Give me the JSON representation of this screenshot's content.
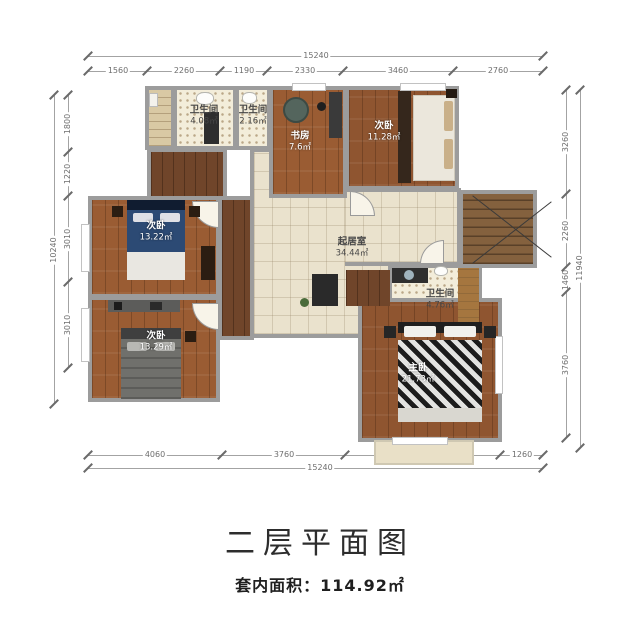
{
  "title": "二层平面图",
  "subtitle": "套内面积：114.92㎡",
  "rooms": {
    "bath_top_left": {
      "name": "卫生间",
      "area": "4.08㎡"
    },
    "bath_top_mid": {
      "name": "卫生间",
      "area": "2.16㎡"
    },
    "study": {
      "name": "书房",
      "area": "7.6㎡"
    },
    "bedroom_top_right": {
      "name": "次卧",
      "area": "11.28㎡"
    },
    "bedroom_left_up": {
      "name": "次卧",
      "area": "13.22㎡"
    },
    "bedroom_left_low": {
      "name": "次卧",
      "area": "13.29㎡"
    },
    "living": {
      "name": "起居室",
      "area": "34.44㎡"
    },
    "bath_master": {
      "name": "卫生间",
      "area": "4.76㎡"
    },
    "master": {
      "name": "主卧",
      "area": "21.73㎡"
    }
  },
  "dimensions": {
    "top": {
      "total": "15240",
      "segments": [
        "1560",
        "2260",
        "1190",
        "2330",
        "3460",
        "2760"
      ]
    },
    "bottom": {
      "total": "15240",
      "segments": [
        "4060",
        "3760",
        "4960",
        "1260"
      ]
    },
    "left": {
      "total": "10240",
      "segments": [
        "1800",
        "1220",
        "3010",
        "3010"
      ]
    },
    "right": {
      "total": "11940",
      "segments": [
        "3260",
        "2260",
        "1460",
        "3760"
      ]
    }
  },
  "colors": {
    "wall": "#9c9c9c",
    "wood_floor": "#9a5c33",
    "tile_floor": "#eae2cd",
    "dim_text": "#6e6e6e"
  }
}
